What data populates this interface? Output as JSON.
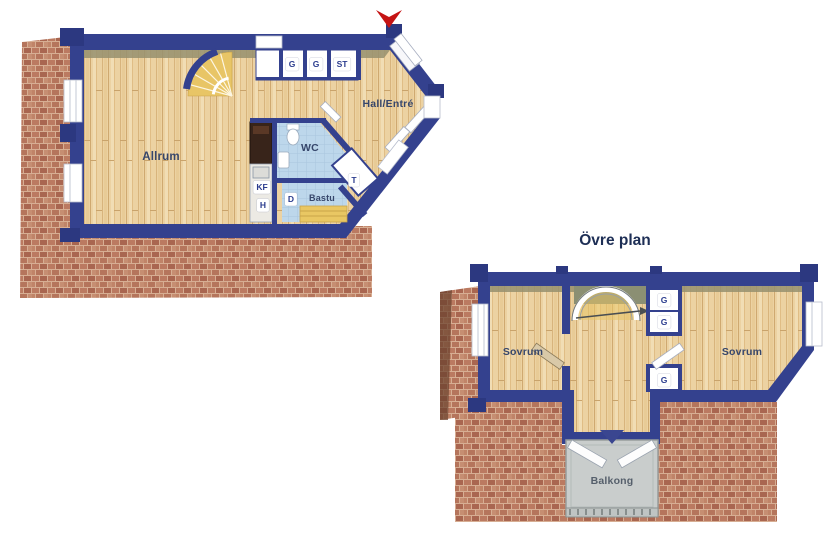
{
  "ground_floor": {
    "rooms": {
      "allrum": "Allrum",
      "hall": "Hall/Entré",
      "wc": "WC",
      "bastu": "Bastu"
    },
    "labels": {
      "closet_g1": "G",
      "closet_g2": "G",
      "closet_st": "ST",
      "fridge_freezer": "KF",
      "hob": "H",
      "shower": "D",
      "laundry": "T"
    }
  },
  "upper_floor": {
    "title": "Övre plan",
    "rooms": {
      "sovrum_left": "Sovrum",
      "sovrum_right": "Sovrum",
      "balkong": "Balkong"
    },
    "labels": {
      "closet_g1": "G",
      "closet_g2": "G",
      "closet_g3": "G"
    }
  },
  "colors": {
    "wall_blue": "#34418e",
    "wood_floor": "#ecd2a2",
    "tile_blue": "#bdd7eb",
    "brick": "#b5755c",
    "balcony_gray": "#c9cdcc",
    "label_blue": "#2b3c8e",
    "entrance_arrow_red": "#c51414"
  }
}
